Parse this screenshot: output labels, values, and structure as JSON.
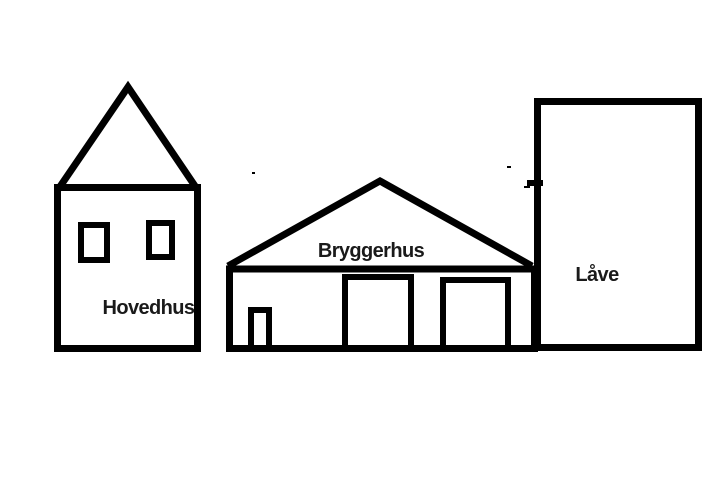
{
  "drawing": {
    "background_color": "#ffffff",
    "line_color": "#000000",
    "labels": {
      "hovedhus": "Hovedhus",
      "bryggerhus": "Bryggerhus",
      "laave": "Låve"
    },
    "buildings": [
      {
        "label": "Hovedhus"
      },
      {
        "label": "Bryggerhus"
      },
      {
        "label": "Låve"
      }
    ]
  }
}
